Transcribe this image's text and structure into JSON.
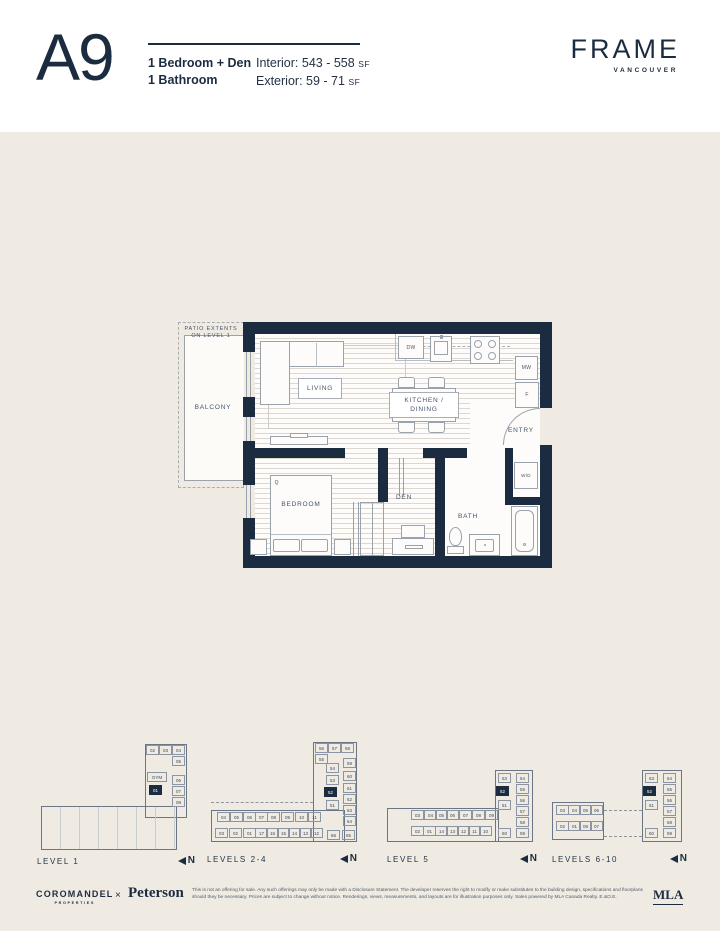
{
  "header": {
    "plan_code": "A9",
    "config_line1": "1 Bedroom + Den",
    "config_line2": "1 Bathroom",
    "interior_label": "Interior:",
    "interior_value": "543 - 558",
    "exterior_label": "Exterior:",
    "exterior_value": "59 - 71",
    "sf": "SF",
    "brand": "FRAME",
    "brand_city": "VANCOUVER"
  },
  "plan": {
    "patio_note": "PATIO EXTENTS\nON LEVEL 1",
    "balcony": "BALCONY",
    "living": "LIVING",
    "kitchen_dining": "KITCHEN /\nDINING",
    "entry": "ENTRY",
    "bedroom": "BEDROOM",
    "den": "DEN",
    "bath": "BATH",
    "wd": "W/D",
    "dw": "DW",
    "mw": "MW",
    "fridge": "F",
    "queen": "Q"
  },
  "north": "N",
  "keyplans": [
    {
      "label": "LEVEL 1",
      "cells": [
        {
          "t": "02",
          "x": 111,
          "y": 3
        },
        {
          "t": "03",
          "x": 124,
          "y": 3
        },
        {
          "t": "04",
          "x": 137,
          "y": 3
        },
        {
          "t": "05",
          "x": 137,
          "y": 14
        },
        {
          "t": "GYM",
          "x": 112,
          "y": 30,
          "w": 20
        },
        {
          "t": "06",
          "x": 137,
          "y": 33
        },
        {
          "t": "01",
          "x": 114,
          "y": 43,
          "filled": true
        },
        {
          "t": "07",
          "x": 137,
          "y": 44
        },
        {
          "t": "08",
          "x": 137,
          "y": 55
        }
      ]
    },
    {
      "label": "LEVELS 2-4",
      "cells": [
        {
          "t": "56",
          "x": 110,
          "y": 3
        },
        {
          "t": "57",
          "x": 123,
          "y": 3
        },
        {
          "t": "58",
          "x": 136,
          "y": 3
        },
        {
          "t": "55",
          "x": 110,
          "y": 14
        },
        {
          "t": "54",
          "x": 121,
          "y": 23
        },
        {
          "t": "59",
          "x": 138,
          "y": 18
        },
        {
          "t": "53",
          "x": 121,
          "y": 35
        },
        {
          "t": "60",
          "x": 138,
          "y": 31
        },
        {
          "t": "52",
          "x": 119,
          "y": 47,
          "filled": true
        },
        {
          "t": "61",
          "x": 138,
          "y": 43
        },
        {
          "t": "62",
          "x": 138,
          "y": 54
        },
        {
          "t": "51",
          "x": 121,
          "y": 60
        },
        {
          "t": "63",
          "x": 138,
          "y": 65
        },
        {
          "t": "64",
          "x": 138,
          "y": 76
        },
        {
          "t": "66",
          "x": 122,
          "y": 90
        },
        {
          "t": "65",
          "x": 137,
          "y": 90
        },
        {
          "t": "04",
          "x": 12,
          "y": 72
        },
        {
          "t": "05",
          "x": 25,
          "y": 72
        },
        {
          "t": "06",
          "x": 38,
          "y": 72
        },
        {
          "t": "07",
          "x": 50,
          "y": 72
        },
        {
          "t": "08",
          "x": 62,
          "y": 72
        },
        {
          "t": "09",
          "x": 76,
          "y": 72
        },
        {
          "t": "10",
          "x": 90,
          "y": 72
        },
        {
          "t": "11",
          "x": 103,
          "y": 72
        },
        {
          "t": "03",
          "x": 10,
          "y": 88
        },
        {
          "t": "02",
          "x": 24,
          "y": 88
        },
        {
          "t": "01",
          "x": 38,
          "y": 88
        },
        {
          "t": "17",
          "x": 50,
          "y": 88
        },
        {
          "t": "16",
          "x": 61,
          "y": 88
        },
        {
          "t": "15",
          "x": 72,
          "y": 88
        },
        {
          "t": "14",
          "x": 83,
          "y": 88
        },
        {
          "t": "13",
          "x": 94,
          "y": 88
        },
        {
          "t": "12",
          "x": 105,
          "y": 88
        }
      ]
    },
    {
      "label": "LEVEL 5",
      "cells": [
        {
          "t": "53",
          "x": 113,
          "y": 33
        },
        {
          "t": "54",
          "x": 131,
          "y": 33
        },
        {
          "t": "52",
          "x": 111,
          "y": 46,
          "filled": true
        },
        {
          "t": "55",
          "x": 131,
          "y": 44
        },
        {
          "t": "56",
          "x": 131,
          "y": 55
        },
        {
          "t": "51",
          "x": 113,
          "y": 60
        },
        {
          "t": "57",
          "x": 131,
          "y": 66
        },
        {
          "t": "58",
          "x": 131,
          "y": 77
        },
        {
          "t": "60",
          "x": 113,
          "y": 88
        },
        {
          "t": "59",
          "x": 131,
          "y": 88
        },
        {
          "t": "03",
          "x": 26,
          "y": 70
        },
        {
          "t": "04",
          "x": 39,
          "y": 70
        },
        {
          "t": "05",
          "x": 50,
          "y": 70
        },
        {
          "t": "06",
          "x": 61,
          "y": 70
        },
        {
          "t": "07",
          "x": 74,
          "y": 70
        },
        {
          "t": "08",
          "x": 87,
          "y": 70
        },
        {
          "t": "09",
          "x": 100,
          "y": 70
        },
        {
          "t": "02",
          "x": 26,
          "y": 86
        },
        {
          "t": "01",
          "x": 38,
          "y": 86
        },
        {
          "t": "14",
          "x": 50,
          "y": 86
        },
        {
          "t": "13",
          "x": 61,
          "y": 86
        },
        {
          "t": "12",
          "x": 72,
          "y": 86
        },
        {
          "t": "11",
          "x": 83,
          "y": 86
        },
        {
          "t": "10",
          "x": 94,
          "y": 86
        }
      ]
    },
    {
      "label": "LEVELS 6-10",
      "cells": [
        {
          "t": "03",
          "x": 6,
          "y": 65
        },
        {
          "t": "04",
          "x": 18,
          "y": 65
        },
        {
          "t": "05",
          "x": 29,
          "y": 65
        },
        {
          "t": "06",
          "x": 40,
          "y": 65
        },
        {
          "t": "02",
          "x": 6,
          "y": 81
        },
        {
          "t": "01",
          "x": 18,
          "y": 81
        },
        {
          "t": "08",
          "x": 29,
          "y": 81
        },
        {
          "t": "07",
          "x": 40,
          "y": 81
        },
        {
          "t": "53",
          "x": 95,
          "y": 33
        },
        {
          "t": "54",
          "x": 113,
          "y": 33
        },
        {
          "t": "52",
          "x": 93,
          "y": 46,
          "filled": true
        },
        {
          "t": "55",
          "x": 113,
          "y": 44
        },
        {
          "t": "56",
          "x": 113,
          "y": 55
        },
        {
          "t": "51",
          "x": 95,
          "y": 60
        },
        {
          "t": "57",
          "x": 113,
          "y": 66
        },
        {
          "t": "58",
          "x": 113,
          "y": 77
        },
        {
          "t": "60",
          "x": 95,
          "y": 88
        },
        {
          "t": "59",
          "x": 113,
          "y": 88
        }
      ]
    }
  ],
  "footer": {
    "developer": "COROMANDEL",
    "developer_sub": "PROPERTIES",
    "times": "×",
    "partner": "Peterson",
    "disclaimer": "This is not an offering for sale. Any such offerings may only be made with a Disclosure Statement. The developer reserves the right to modify or make substitutes to the building design, specifications and floorplans should they be necessary. Prices are subject to change without notice. Renderings, views, measurements, and layouts are for illustration purposes only. Sales powered by MLA Canada Realty. E.&O.E.",
    "broker": "MLA"
  }
}
